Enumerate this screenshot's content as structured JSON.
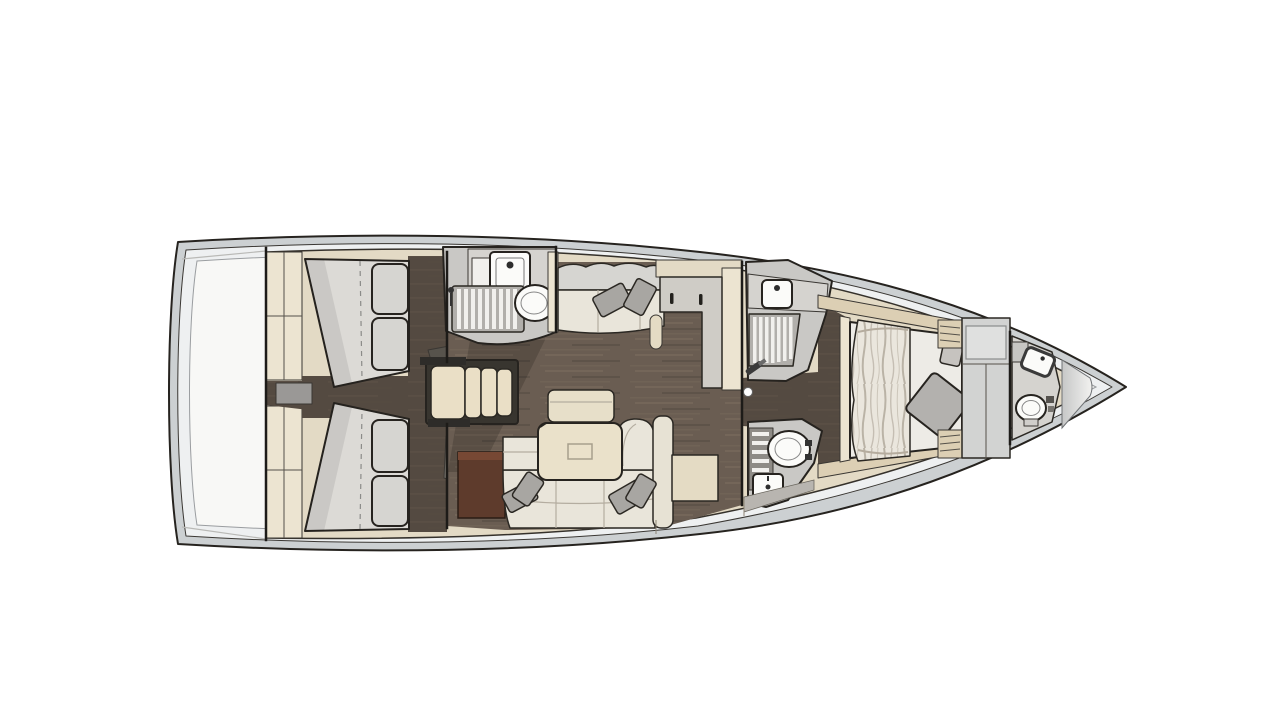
{
  "diagram": {
    "kind": "sailing-yacht-interior-floor-plan",
    "orientation": {
      "bow": "right",
      "stern": "left"
    },
    "areas": [
      {
        "name": "stern-platform",
        "fixtures": []
      },
      {
        "name": "aft-cabin-port",
        "fixtures": [
          "double-bed",
          "pillows",
          "wardrobe",
          "cabin-door"
        ]
      },
      {
        "name": "aft-cabin-starboard",
        "fixtures": [
          "double-bed",
          "pillows",
          "wardrobe",
          "cabin-door"
        ]
      },
      {
        "name": "companionway",
        "fixtures": [
          "steps",
          "engine-hatch"
        ]
      },
      {
        "name": "aft-head",
        "fixtures": [
          "sink",
          "toilet",
          "shower-grate",
          "vanity-cabinet"
        ]
      },
      {
        "name": "salon",
        "fixtures": [
          "settee",
          "sofa",
          "table",
          "stool-bench",
          "storage-cabinet",
          "side-bench",
          "throw-pillows"
        ]
      },
      {
        "name": "galley-unit",
        "fixtures": [
          "l-shaped-counter",
          "drawer-handles",
          "grab-rail"
        ]
      },
      {
        "name": "forward-shower-room",
        "fixtures": [
          "sink",
          "shower-grate",
          "shower-wand"
        ]
      },
      {
        "name": "forward-toilet-room",
        "fixtures": [
          "toilet",
          "sink",
          "slatted-shelf"
        ]
      },
      {
        "name": "owner-cabin",
        "fixtures": [
          "double-bed",
          "blanket",
          "pillow",
          "wardrobe",
          "slatted-shelves"
        ]
      },
      {
        "name": "bow-head",
        "fixtures": [
          "sink",
          "toilet",
          "cabinet"
        ]
      },
      {
        "name": "sail-locker",
        "fixtures": []
      }
    ]
  },
  "colors": {
    "page_bg": "#ffffff",
    "hull_band": "#ccd0d2",
    "hull_inner": "#eef0f1",
    "deck_white": "#f8f8f6",
    "deck_beige": "#e3dac5",
    "wall_cream": "#ece4d1",
    "floor_base": "#6a5d52",
    "floor_light": "#7b6d5f",
    "floor_dark": "#564c42",
    "floor2_base": "#544a41",
    "floor2_light": "#5f5349",
    "step_frame": "#38352f",
    "step_tread": "#eadfc6",
    "engine_hatch": "#9a9896",
    "mattress": "#dcdad6",
    "pillow_case": "#d6d5d1",
    "throw_pillow": "#a8a6a2",
    "door_panel": "#7a766f",
    "sofa": "#e9e5da",
    "back_panel": "#e7e2d4",
    "table": "#eae1ca",
    "stool": "#e7dfc9",
    "bench": "#e4dbc4",
    "cabinet_brown": "#5e3b2c",
    "cabinet_brown_top": "#774834",
    "bath_floor": "#c9c8c5",
    "counter": "#d5d3cf",
    "fixture_white": "#fbfbf9",
    "grate_gray": "#b1afab",
    "slat_white": "#f1f0ed",
    "galley_counter": "#cfccc6",
    "wardrobe": "#d2d3d2",
    "wardrobe_hatch": "#dfe0df",
    "blanket_base": "#eae6dd",
    "blanket_streak": "#a69d8f",
    "bed_white": "#edebe6",
    "fwd_pillow": "#b3b1ae",
    "shelf_slat": "#dccfb4",
    "seat_gray": "#b8b5b0",
    "locker_light": "#f2f2f0",
    "locker_dark": "#c6c7c7"
  }
}
